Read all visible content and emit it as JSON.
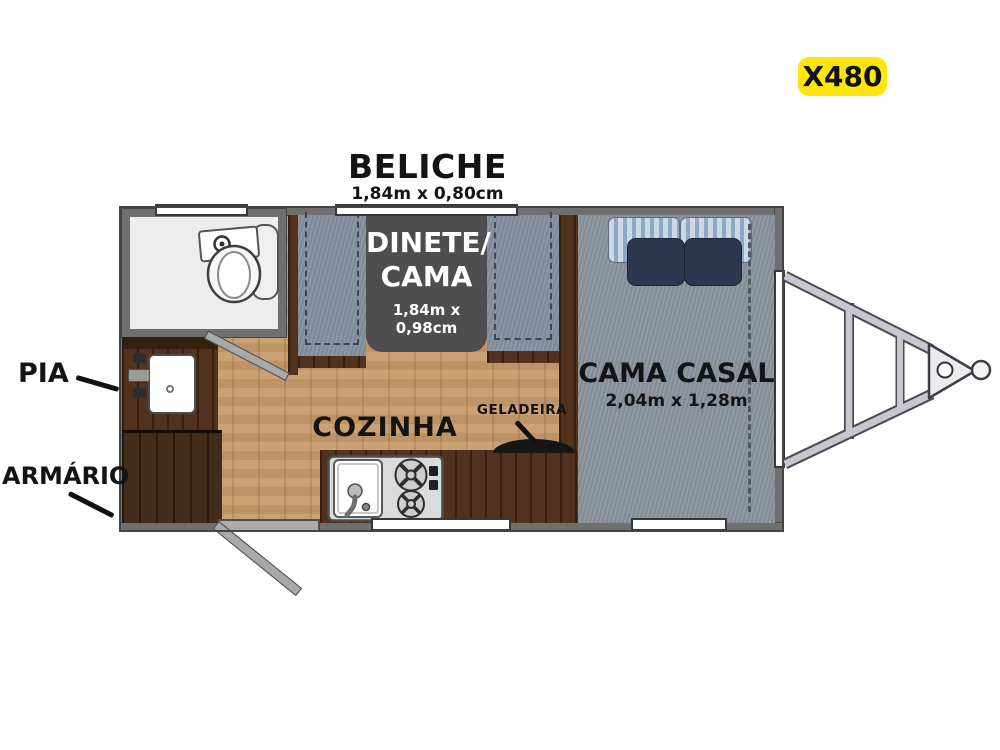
{
  "badge": {
    "label": "X480"
  },
  "header": {
    "title": "BELICHE",
    "dimensions": "1,84m x 0,80cm"
  },
  "areas": {
    "dinette": {
      "label_line1": "DINETE/",
      "label_line2": "CAMA",
      "dimensions": "1,84m x 0,98cm"
    },
    "double_bed": {
      "label": "CAMA CASAL",
      "dimensions": "2,04m x 1,28m"
    },
    "kitchen": {
      "label": "COZINHA"
    },
    "refrigerator": {
      "label": "GELADEIRA"
    },
    "sink": {
      "label": "PIA"
    },
    "cabinet": {
      "label": "ARMÁRIO"
    }
  },
  "colors": {
    "badge_bg": "#ffe60a",
    "wall": "#6f6f6f",
    "wood_floor": "#c59a6b",
    "counter_brown": "#4b2c17",
    "cabinet_dark": "#3a2412",
    "bench": "#8492a1",
    "bed": "#8b949d",
    "table": "#4e4e4e",
    "bathroom_floor": "#ededed",
    "pillow_navy": "#2d3850",
    "pillow_stripe_light": "#cbd9e7",
    "pillow_stripe_dark": "#8fa9c5",
    "hitch_metal": "#c7c7d2"
  }
}
